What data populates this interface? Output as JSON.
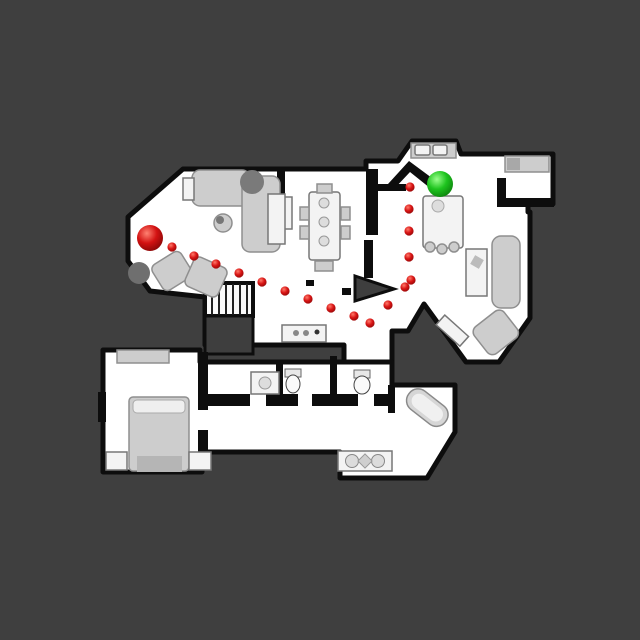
{
  "scene": {
    "type": "top-down house floor plan scan with navigation path overlay",
    "background_color": "#3f3f3f",
    "floor_color": "#ffffff",
    "wall_color": "#0d0d0d",
    "furniture_color": "#cdcdcd"
  },
  "navigation": {
    "start_marker": {
      "x": 150,
      "y": 238,
      "radius": 13,
      "color": "#cc1111"
    },
    "goal_marker": {
      "x": 440,
      "y": 184,
      "radius": 13,
      "color": "#1fbe1f"
    },
    "path_dot_radius": 4.6,
    "path_dot_color": "#cc1111",
    "path_points": [
      {
        "x": 172,
        "y": 247
      },
      {
        "x": 194,
        "y": 256
      },
      {
        "x": 216,
        "y": 264
      },
      {
        "x": 239,
        "y": 273
      },
      {
        "x": 262,
        "y": 282
      },
      {
        "x": 285,
        "y": 291
      },
      {
        "x": 308,
        "y": 299
      },
      {
        "x": 331,
        "y": 308
      },
      {
        "x": 354,
        "y": 316
      },
      {
        "x": 370,
        "y": 323
      },
      {
        "x": 388,
        "y": 305
      },
      {
        "x": 405,
        "y": 287
      },
      {
        "x": 411,
        "y": 280
      },
      {
        "x": 409,
        "y": 257
      },
      {
        "x": 409,
        "y": 231
      },
      {
        "x": 409,
        "y": 209
      },
      {
        "x": 410,
        "y": 187
      }
    ]
  }
}
